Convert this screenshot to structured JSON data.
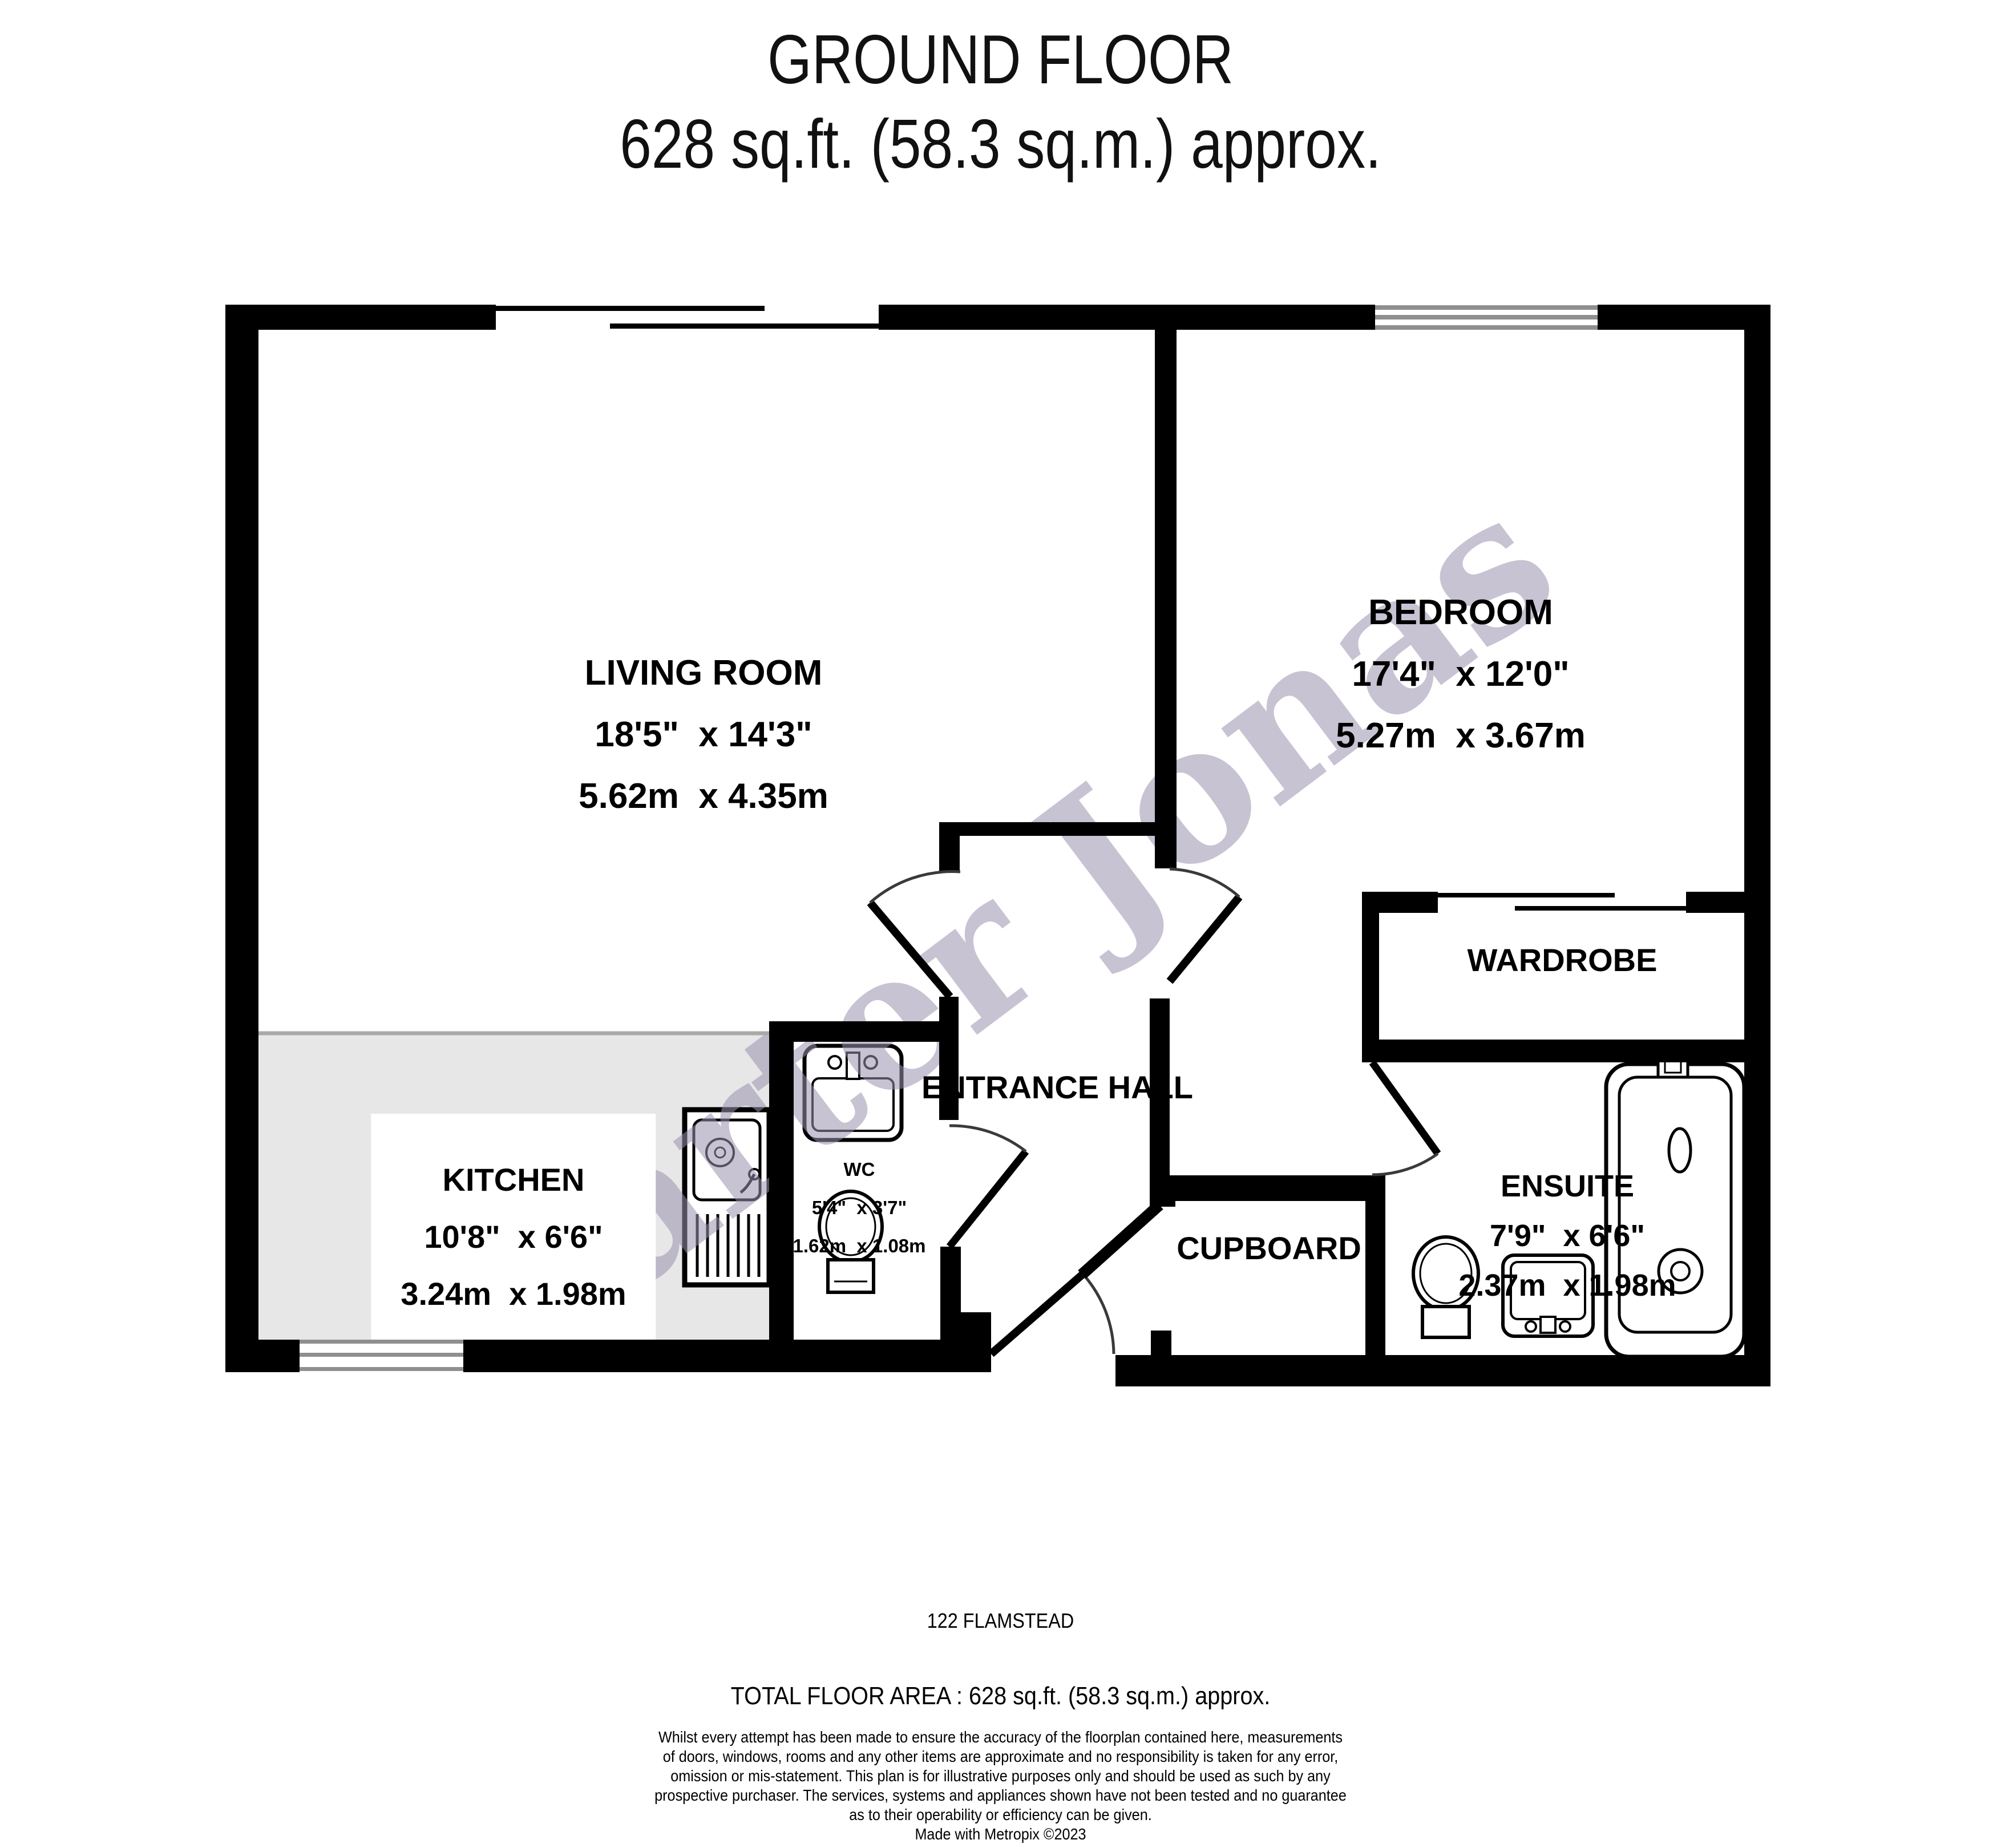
{
  "title": {
    "line1": "GROUND FLOOR",
    "line2": "628 sq.ft. (58.3 sq.m.) approx."
  },
  "watermark_text": "Carter Jonas",
  "rooms": {
    "living_room": {
      "name": "LIVING ROOM",
      "imperial": "18'5\"  x 14'3\"",
      "metric": "5.62m  x 4.35m"
    },
    "bedroom": {
      "name": "BEDROOM",
      "imperial": "17'4\"  x 12'0\"",
      "metric": "5.27m  x 3.67m"
    },
    "kitchen": {
      "name": "KITCHEN",
      "imperial": "10'8\"  x 6'6\"",
      "metric": "3.24m  x 1.98m"
    },
    "wc": {
      "name": "WC",
      "imperial": "5'4\"  x 3'7\"",
      "metric": "1.62m  x 1.08m"
    },
    "ensuite": {
      "name": "ENSUITE",
      "imperial": "7'9\"  x 6'6\"",
      "metric": "2.37m  x 1.98m"
    },
    "entrance_hall": {
      "name": "ENTRANCE HALL"
    },
    "wardrobe": {
      "name": "WARDROBE"
    },
    "cupboard": {
      "name": "CUPBOARD"
    }
  },
  "footer": {
    "address": "122 FLAMSTEAD",
    "total_area": "TOTAL FLOOR AREA : 628 sq.ft. (58.3 sq.m.) approx.",
    "disclaimer": [
      "Whilst every attempt has been made to ensure the accuracy of the floorplan contained here, measurements",
      "of doors, windows, rooms and any other items are approximate and no responsibility is taken for any error,",
      "omission or mis-statement. This plan is for illustrative purposes only and should be used as such by any",
      "prospective purchaser. The services, systems and appliances shown have not been tested and no guarantee",
      "as to their operability or efficiency can be given.",
      "Made with Metropix ©2023"
    ]
  },
  "colors": {
    "wall": "#000000",
    "window_frame": "#8f8f8f",
    "kitchen_floor": "#e7e7e7",
    "watermark": "#9991af"
  }
}
